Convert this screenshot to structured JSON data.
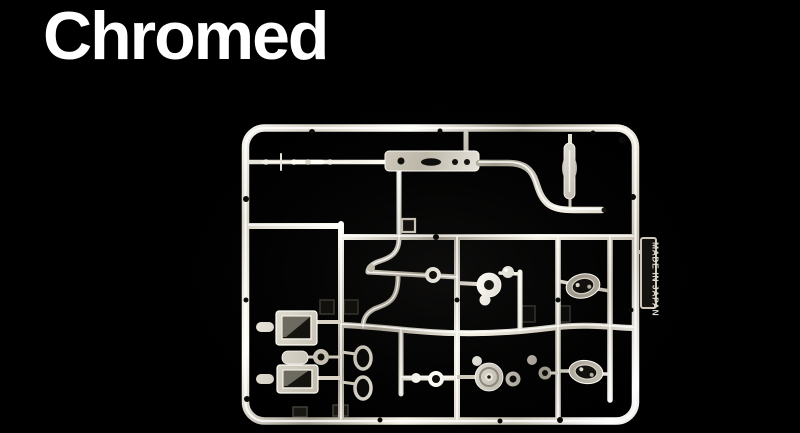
{
  "header": {
    "title": "Chromed",
    "title_color": "#ffffff"
  },
  "photo": {
    "background_color": "#000000",
    "subject": "chrome-plated model kit parts sprue",
    "tag_text": "MADE IN JAPAN",
    "chrome_highlight": "#fffdf4",
    "chrome_mid": "#d4cec1",
    "chrome_shadow": "#80796c",
    "part_labels": [
      "antenna",
      "front-bumper-bar",
      "muffler",
      "exhaust-pipe",
      "box-part",
      "box-part",
      "mirror-ring",
      "mirror-ring",
      "horn-part",
      "pulley-part",
      "lamp-bucket",
      "lamp-bucket",
      "made-in-japan-tag"
    ]
  }
}
